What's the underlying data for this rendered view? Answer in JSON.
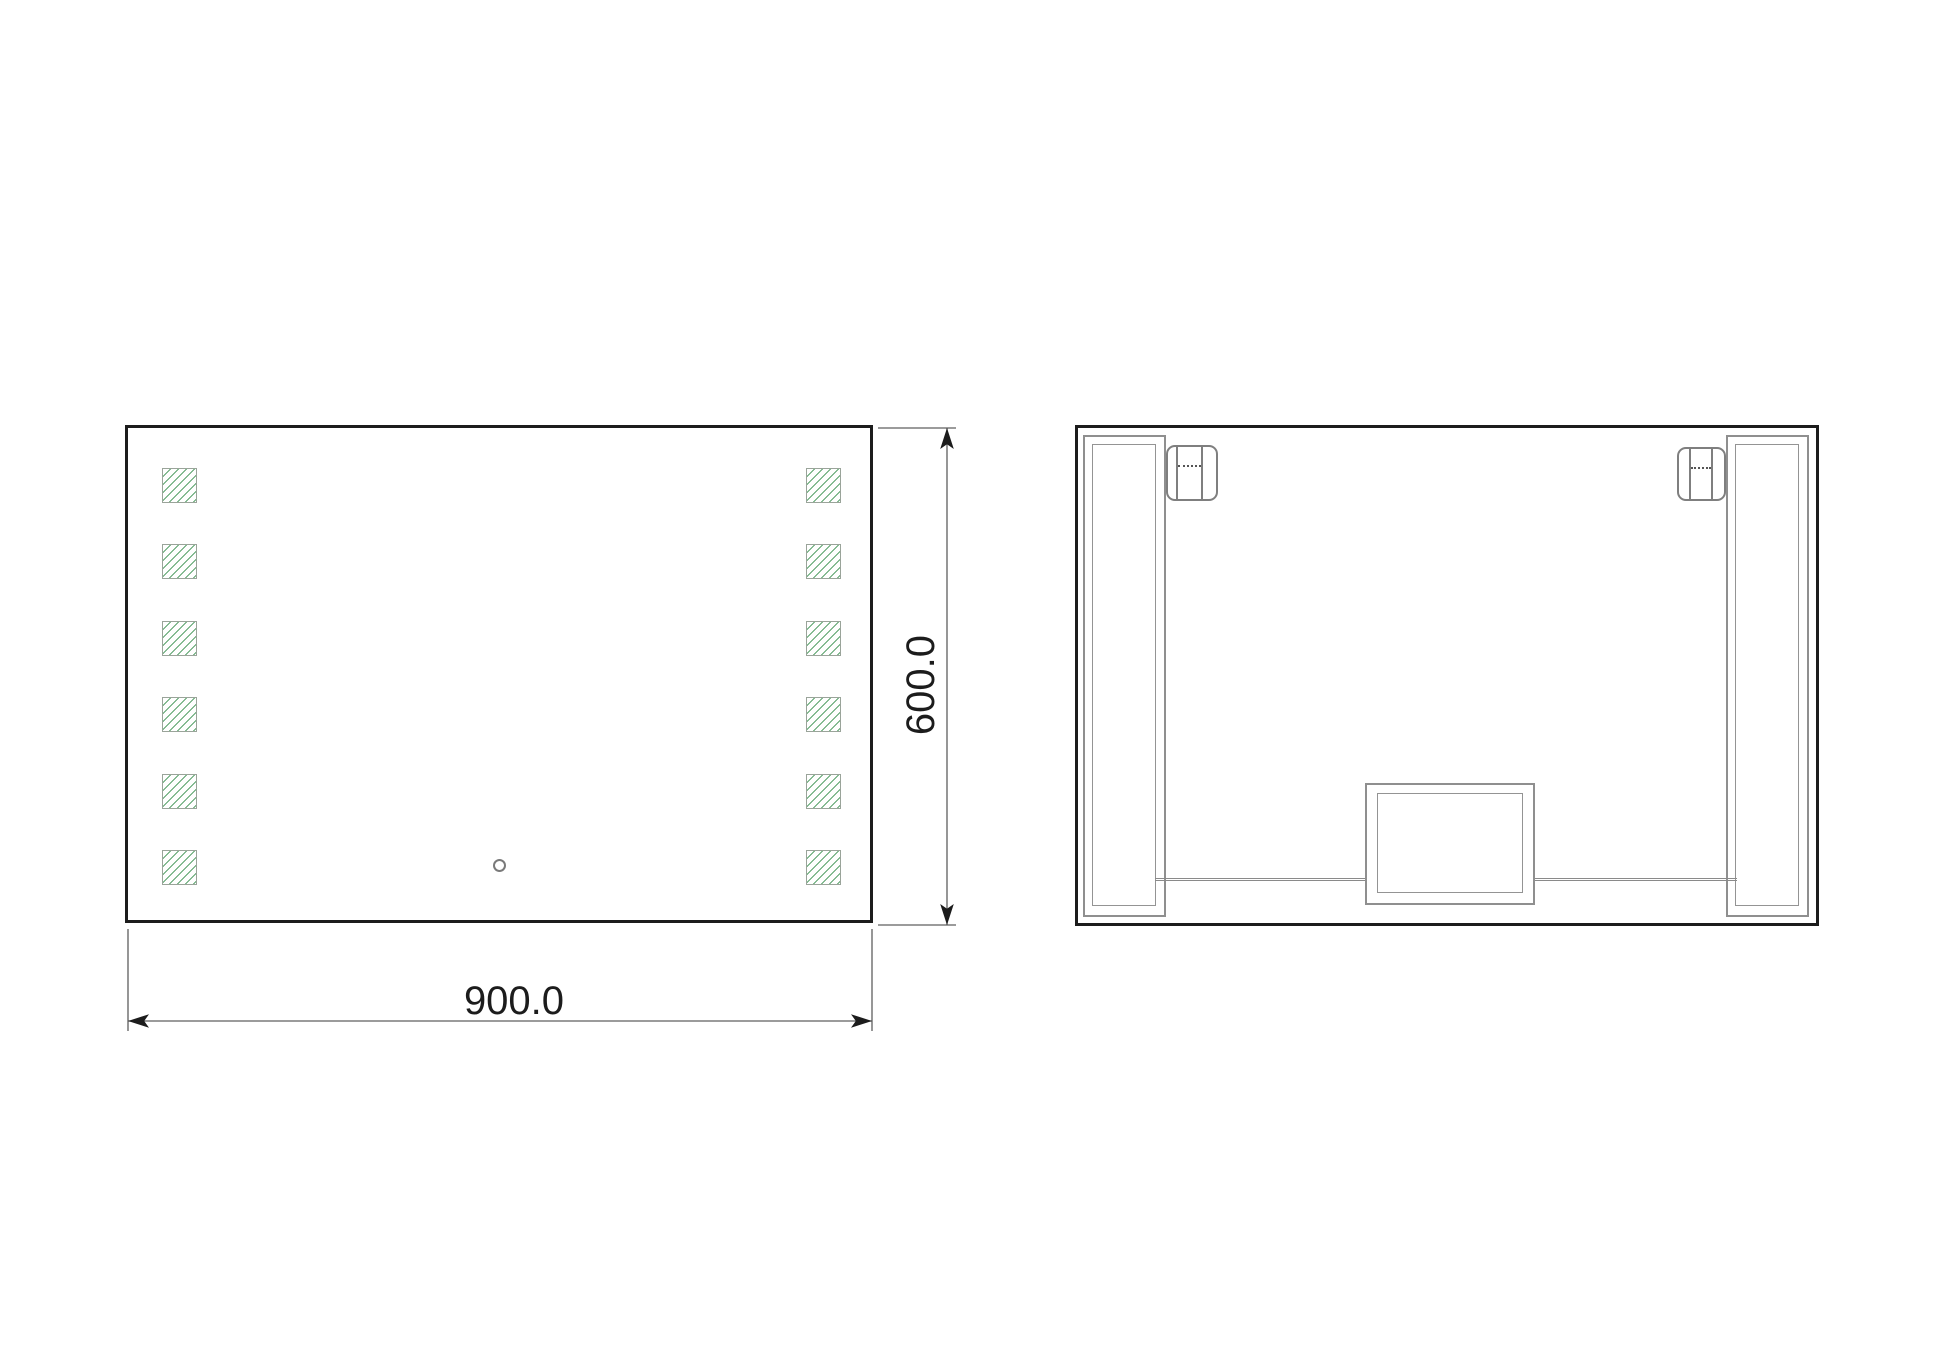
{
  "front_view": {
    "name": "mirror front view",
    "width_label": "900.0",
    "height_label": "600.0",
    "led_rows": 6,
    "led_columns": 2,
    "touch_sensor_count": 1
  },
  "back_view": {
    "name": "mirror back view",
    "hanging_rails": 2,
    "spring_clips": 2,
    "junction_boxes": 1,
    "wire_segments": 2
  },
  "colors": {
    "outline": "#1c1c1c",
    "hardware_gray": "#8f8f8f",
    "dimension_line": "#5f5f5f",
    "hatch_green": "#5fa571",
    "background": "#ffffff"
  }
}
